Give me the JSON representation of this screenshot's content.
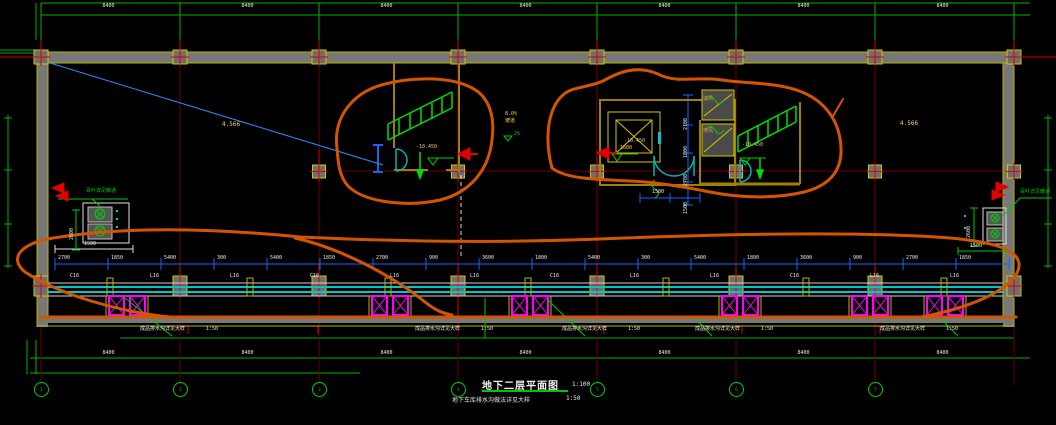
{
  "drawing": {
    "title": "地下二层平面图",
    "scale": "1:100",
    "subtitle": "地下车库排水沟做法详见大样",
    "subtitle_scale": "1:50"
  },
  "axes": {
    "bubbles": [
      "1",
      "2",
      "3",
      "4",
      "5",
      "6",
      "7"
    ],
    "top_dims": [
      "8400",
      "8400",
      "8400",
      "8400",
      "8400",
      "8400",
      "8400"
    ],
    "bottom_dims": [
      "8400",
      "8400",
      "8400",
      "8400",
      "8400",
      "8400",
      "8400"
    ]
  },
  "band": {
    "chain_dims": [
      "2700",
      "1850",
      "5400",
      "300",
      "5400",
      "1850",
      "2700",
      "900",
      "3600",
      "1800",
      "5400",
      "300",
      "5400",
      "1800",
      "3600",
      "900",
      "2700",
      "1850"
    ],
    "beam_labels": [
      "C16",
      "L16",
      "L16",
      "C16",
      "L16",
      "L16",
      "C16",
      "L16",
      "L16",
      "C16",
      "L16",
      "L16"
    ],
    "drain_note": "成品排水沟详见大样",
    "drain_scale": "1:50"
  },
  "core": {
    "vert_dims": [
      "2100",
      "1800",
      "2700",
      "1500"
    ],
    "door_dim": "1500",
    "elevator_label": "1600",
    "vent_labels": [
      "进风",
      "排风"
    ]
  },
  "equipment": {
    "width_dim": "1500",
    "height_dim": "2600",
    "leader_note": "百叶详见暖通"
  },
  "levels": {
    "value": "-10.450"
  },
  "ramp": {
    "grade": "8.0%",
    "label": "坡道",
    "note": "2%"
  },
  "misc": {
    "area_left": "4.566",
    "area_right": "4.566"
  },
  "colors": {
    "background": "#000000",
    "grid_green": "#00c800",
    "dim_blue": "#1464ff",
    "markup_orange": "#d45500",
    "wall_gray": "#787878",
    "column_yellow": "#d4c800",
    "highlight_magenta": "#ff00ff",
    "trench_cyan": "#00c8c8",
    "axis_red": "#e00000"
  }
}
